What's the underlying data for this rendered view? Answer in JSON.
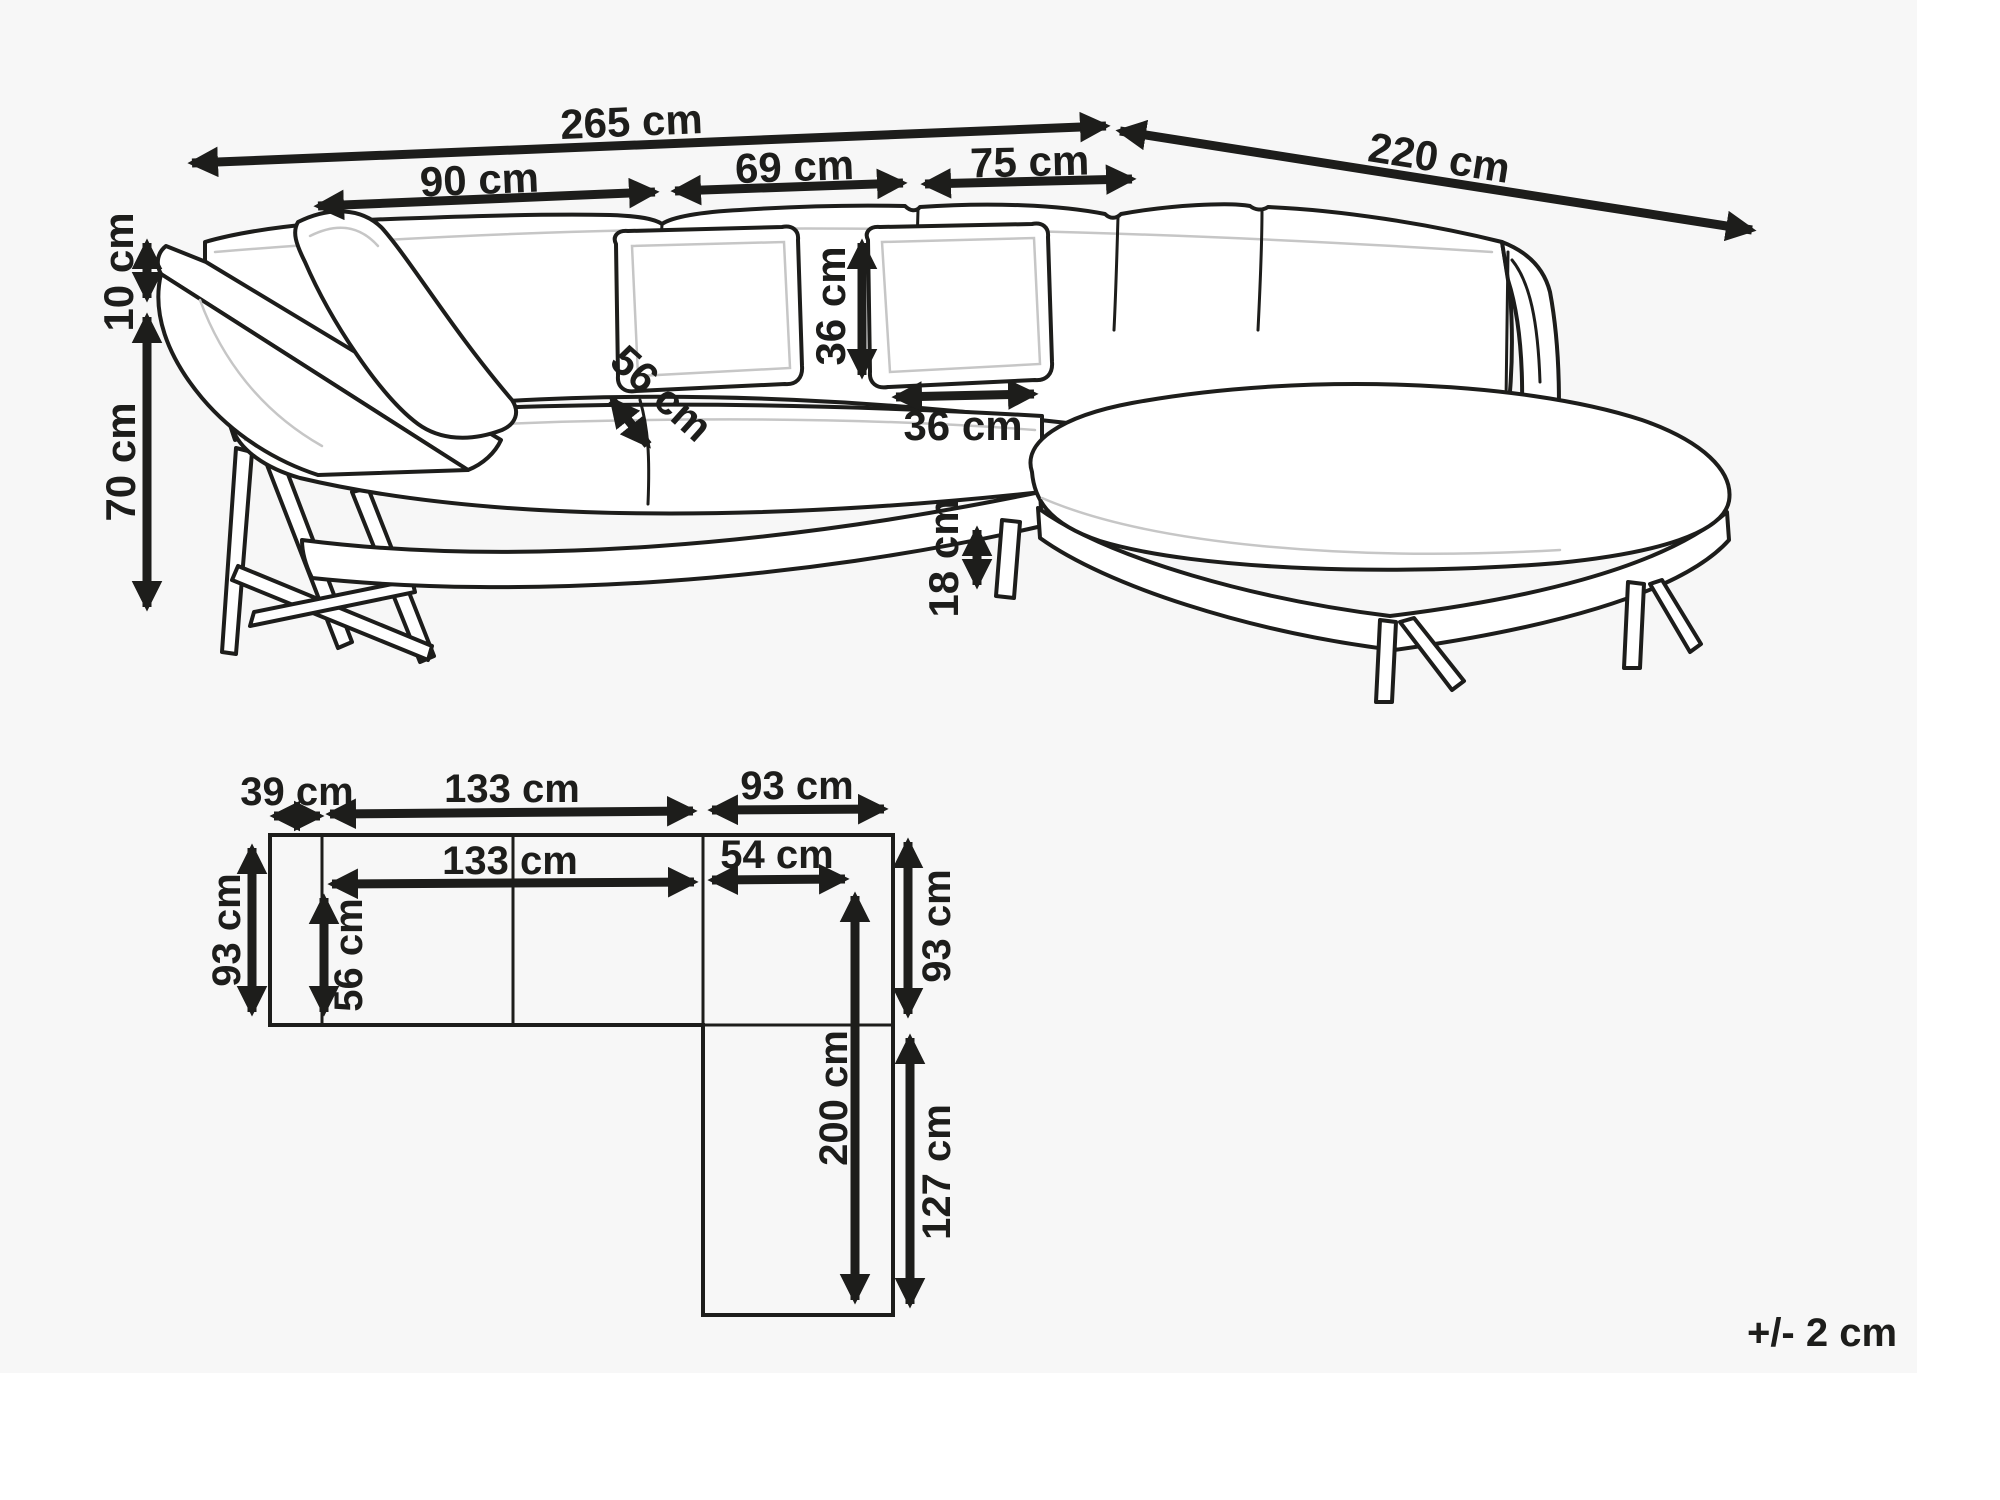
{
  "note": {
    "tolerance": "+/- 2 cm"
  },
  "top_dims": {
    "overall_width": "265 cm",
    "overall_depth": "220 cm",
    "section_left": "90 cm",
    "section_middle": "69 cm",
    "section_right": "75 cm",
    "headrest_height": "10 cm",
    "back_height": "70 cm",
    "pillow_height": "36 cm",
    "pillow_width": "36 cm",
    "seat_depth": "56 cm",
    "leg_height": "18 cm"
  },
  "plan_dims": {
    "armrest_width": "39 cm",
    "top_seat_width": "133 cm",
    "top_chaise_width": "93 cm",
    "inner_seat_width": "133 cm",
    "inner_chaise_width": "54 cm",
    "left_depth": "93 cm",
    "inner_depth": "56 cm",
    "right_depth": "93 cm",
    "chaise_length": "200 cm",
    "chaise_inner_length": "127 cm"
  },
  "colors": {
    "ink": "#1d1d1b",
    "canvas_tint": "#f7f7f7",
    "background": "#ffffff"
  }
}
